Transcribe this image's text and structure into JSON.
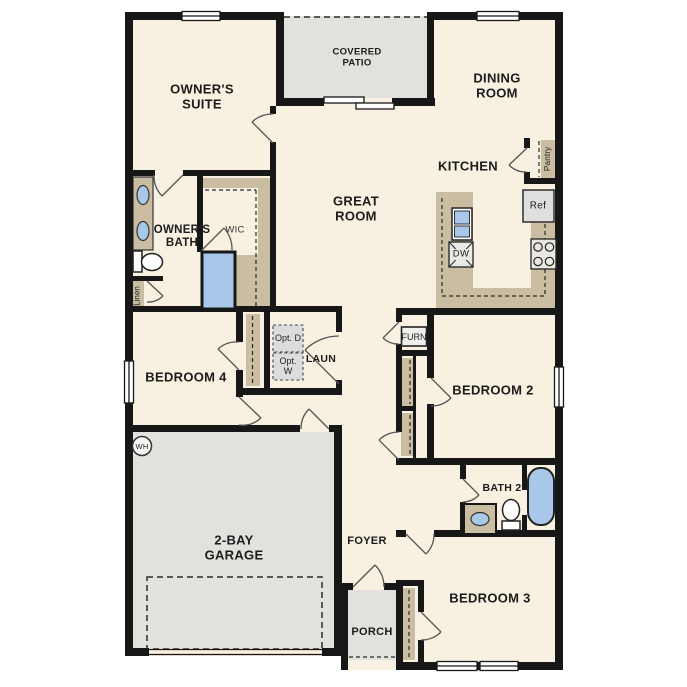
{
  "page": {
    "kind": "single-story house floor plan drawing",
    "background": "#ffffff"
  },
  "colors": {
    "wall": "#171717",
    "floor": "#f8f0e1",
    "outdoor_concrete": "#e2e1de",
    "casework_tan": "#cabda2",
    "fixture_blue": "#a9c8e9",
    "appliance_gray": "#dfdfdf",
    "door_swing": "#555555"
  },
  "rooms": {
    "owners_suite": "OWNER'S SUITE",
    "covered_patio": "COVERED PATIO",
    "dining_room": "DINING ROOM",
    "kitchen": "KITCHEN",
    "great_room": "GREAT ROOM",
    "owners_bath": "OWNER'S BATH",
    "wic": "WIC",
    "bedroom4": "BEDROOM 4",
    "laundry": "LAUN",
    "bedroom2": "BEDROOM 2",
    "bath2": "BATH 2",
    "garage": "2-BAY GARAGE",
    "foyer": "FOYER",
    "porch": "PORCH",
    "bedroom3": "BEDROOM 3"
  },
  "fixtures": {
    "pantry": "Pantry",
    "linen": "Linen",
    "refrigerator": "Ref",
    "dishwasher": "DW",
    "opt_dryer": "Opt. D",
    "opt_washer": "Opt. W",
    "furnace": "FURN",
    "water_heater": "WH"
  }
}
